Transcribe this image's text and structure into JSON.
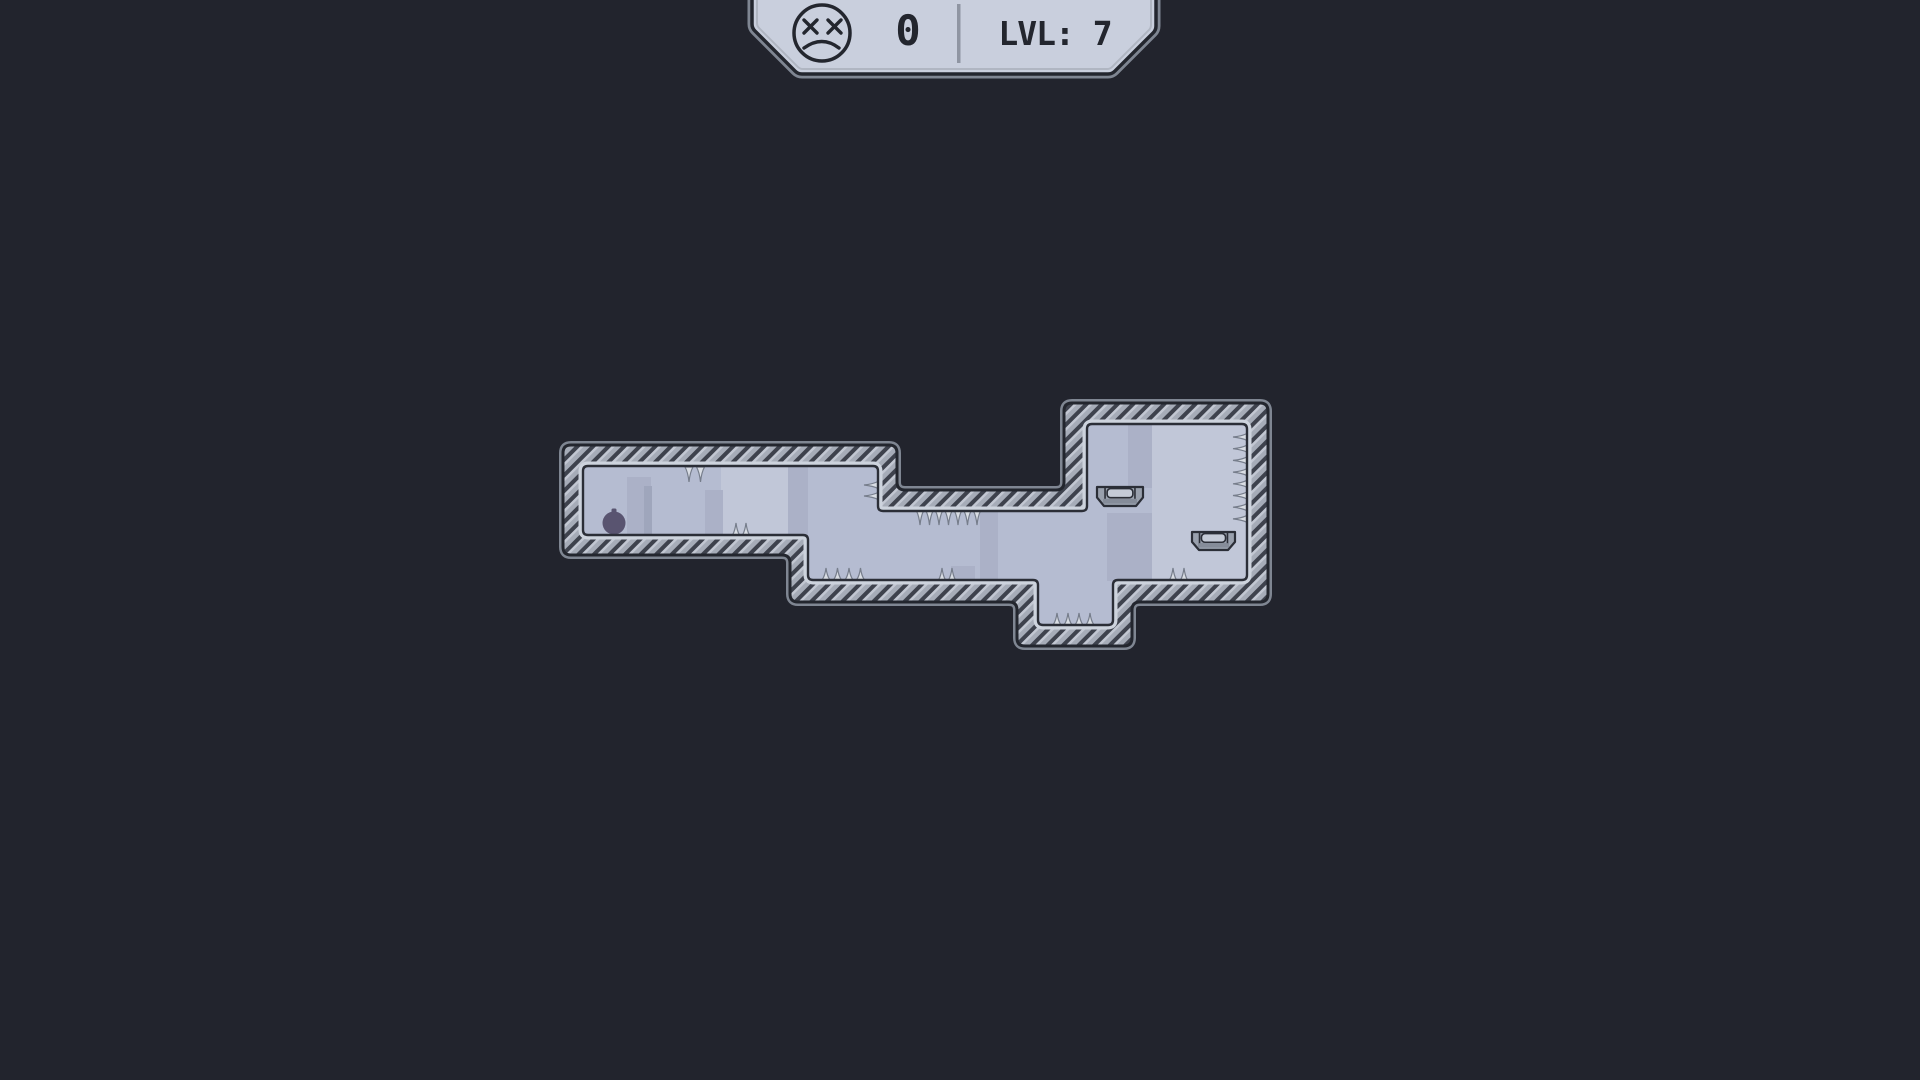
{
  "hud": {
    "death_count": "0",
    "level_label": "LVL: 7",
    "deaths_icon": "dead-face-icon",
    "divider": "vertical-line"
  },
  "colors": {
    "background": "#22242d",
    "outline": "#23262e",
    "inner_outline": "#2b2e37",
    "halo": "#7f8692",
    "hatch_light": "#a6acb8",
    "hatch_dark": "#3e424d",
    "hatch_highlight": "#c2c7d2",
    "bevel_light": "#cdd3dd",
    "interior": "#b5bcd1",
    "interior_light": "#c1c7d8",
    "interior_dark": "#abb1c7",
    "interior_shadow": "#9fa6bc",
    "spike_fill": "#d9dde4",
    "spike_outline": "#767d8b",
    "platform_fill": "#99a0ad",
    "platform_cap": "#c5cbd7",
    "platform_shade": "#858c99",
    "player_fill": "#595470",
    "panel_fill": "#c9cfdd",
    "panel_inner_line": "#b0b6c2",
    "hud_text": "#23262e",
    "divider": "#8f95a2"
  },
  "level": {
    "outer_polygon": [
      [
        563,
        445
      ],
      [
        897,
        445
      ],
      [
        897,
        490
      ],
      [
        1064,
        490
      ],
      [
        1064,
        403
      ],
      [
        1268,
        403
      ],
      [
        1268,
        602
      ],
      [
        1132,
        602
      ],
      [
        1132,
        646
      ],
      [
        1017,
        646
      ],
      [
        1017,
        602
      ],
      [
        790,
        602
      ],
      [
        790,
        555
      ],
      [
        563,
        555
      ]
    ],
    "inner_polygon": [
      [
        583,
        466
      ],
      [
        878,
        466
      ],
      [
        878,
        511
      ],
      [
        1087,
        511
      ],
      [
        1087,
        424
      ],
      [
        1247,
        424
      ],
      [
        1247,
        580
      ],
      [
        1113,
        580
      ],
      [
        1113,
        625
      ],
      [
        1038,
        625
      ],
      [
        1038,
        580
      ],
      [
        808,
        580
      ],
      [
        808,
        535
      ],
      [
        583,
        535
      ]
    ],
    "shading_rects": [
      {
        "x": 721,
        "y": 466,
        "w": 67,
        "h": 70,
        "color_key": "interior_light"
      },
      {
        "x": 788,
        "y": 466,
        "w": 20,
        "h": 70,
        "color_key": "interior_dark"
      },
      {
        "x": 627,
        "y": 477,
        "w": 24,
        "h": 59,
        "color_key": "interior_dark"
      },
      {
        "x": 644,
        "y": 486,
        "w": 8,
        "h": 50,
        "color_key": "interior_shadow"
      },
      {
        "x": 705,
        "y": 490,
        "w": 18,
        "h": 46,
        "color_key": "interior_dark"
      },
      {
        "x": 951,
        "y": 566,
        "w": 24,
        "h": 15,
        "color_key": "interior_dark"
      },
      {
        "x": 980,
        "y": 511,
        "w": 18,
        "h": 70,
        "color_key": "interior_dark"
      },
      {
        "x": 1107,
        "y": 513,
        "w": 45,
        "h": 68,
        "color_key": "interior_dark"
      },
      {
        "x": 1128,
        "y": 424,
        "w": 24,
        "h": 64,
        "color_key": "interior_dark"
      },
      {
        "x": 1152,
        "y": 424,
        "w": 95,
        "h": 157,
        "color_key": "interior_light"
      }
    ],
    "spike_groups": [
      {
        "name": "ceiling-spikes-left-arm",
        "dir": "down",
        "x": 689,
        "y": 467,
        "count": 2,
        "spacing": 11.5,
        "len": 15,
        "hw": 4
      },
      {
        "name": "floor-spikes-left-arm",
        "dir": "up",
        "x": 736,
        "y": 535,
        "count": 2,
        "spacing": 10,
        "len": 12,
        "hw": 3.5
      },
      {
        "name": "wall-spikes-notch",
        "dir": "left",
        "x": 878,
        "y": 485,
        "count": 2,
        "spacing": 11,
        "len": 14,
        "hw": 3.5
      },
      {
        "name": "ceiling-spikes-notch",
        "dir": "down",
        "x": 920,
        "y": 511,
        "count": 7,
        "spacing": 9.5,
        "len": 14,
        "hw": 3.5
      },
      {
        "name": "floor-spikes-middle-a",
        "dir": "up",
        "x": 826,
        "y": 580,
        "count": 4,
        "spacing": 11.5,
        "len": 12,
        "hw": 4
      },
      {
        "name": "floor-spikes-middle-b",
        "dir": "up",
        "x": 942,
        "y": 580,
        "count": 2,
        "spacing": 10,
        "len": 12,
        "hw": 3.5
      },
      {
        "name": "pit-spikes",
        "dir": "up",
        "x": 1057,
        "y": 625,
        "count": 4,
        "spacing": 11,
        "len": 12,
        "hw": 4
      },
      {
        "name": "wall-spikes-right-room",
        "dir": "left",
        "x": 1247,
        "y": 437,
        "count": 8,
        "spacing": 11.7,
        "len": 14,
        "hw": 3.5
      },
      {
        "name": "floor-spikes-right-room",
        "dir": "up",
        "x": 1173,
        "y": 580,
        "count": 2,
        "spacing": 11,
        "len": 12,
        "hw": 3.5
      }
    ],
    "platforms": [
      {
        "x": 1097,
        "y": 487,
        "w": 46,
        "h": 19
      },
      {
        "x": 1192,
        "y": 532,
        "w": 43,
        "h": 18
      }
    ],
    "player": {
      "cx": 614,
      "cy": 523,
      "r": 11.5
    }
  },
  "hud_geometry": {
    "panel_points": [
      [
        752,
        -12
      ],
      [
        752,
        28
      ],
      [
        798,
        74
      ],
      [
        1112,
        74
      ],
      [
        1156,
        30
      ],
      [
        1156,
        -12
      ]
    ],
    "inner_line_points": [
      [
        757,
        -12
      ],
      [
        757,
        26
      ],
      [
        800,
        69
      ],
      [
        1110,
        69
      ],
      [
        1151,
        28
      ],
      [
        1151,
        -12
      ]
    ],
    "face": {
      "cx": 822,
      "cy": 33,
      "r": 28
    },
    "divider_rect": {
      "x": 957,
      "y": 4,
      "w": 3.5,
      "h": 59
    },
    "count_pos": {
      "x": 908,
      "y": 45
    },
    "level_pos": {
      "x": 1055,
      "y": 45
    }
  }
}
